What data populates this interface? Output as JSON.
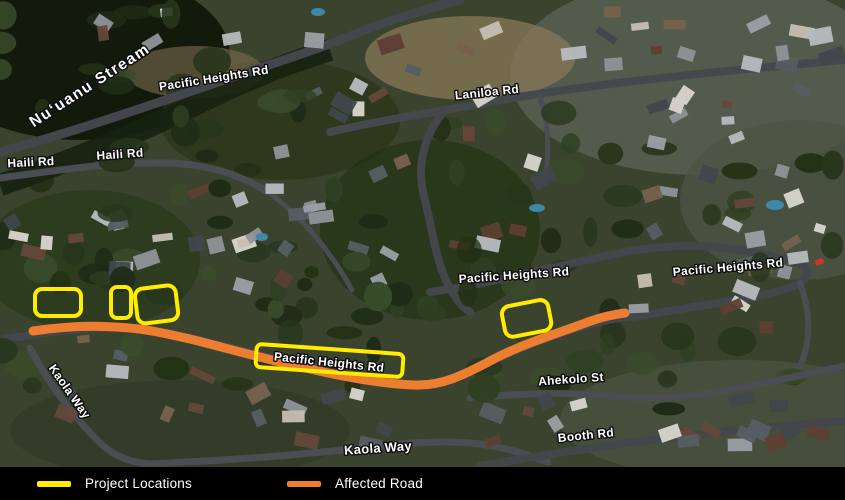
{
  "legend": {
    "items": [
      {
        "label": "Project Locations",
        "color": "#ffec00"
      },
      {
        "label": "Affected Road",
        "color": "#ed7d31"
      }
    ]
  },
  "map": {
    "colors": {
      "project_location": "#ffec00",
      "affected_road": "#ed7d31"
    },
    "labels": {
      "stream": "Nuʻuanu Stream",
      "pacific_heights_top": "Pacific Heights Rd",
      "haili_west": "Haili Rd",
      "haili_east": "Haili Rd",
      "laniloa": "Laniloa Rd",
      "pacific_heights_center": "Pacific Heights Rd",
      "pacific_heights_east": "Pacific Heights Rd",
      "pacific_heights_boxed": "Pacific Heights Rd",
      "kaola_way_west": "Kaola Way",
      "kaola_way_south": "Kaola Way",
      "ahekolo": "Ahekolo St",
      "booth": "Booth Rd"
    }
  }
}
